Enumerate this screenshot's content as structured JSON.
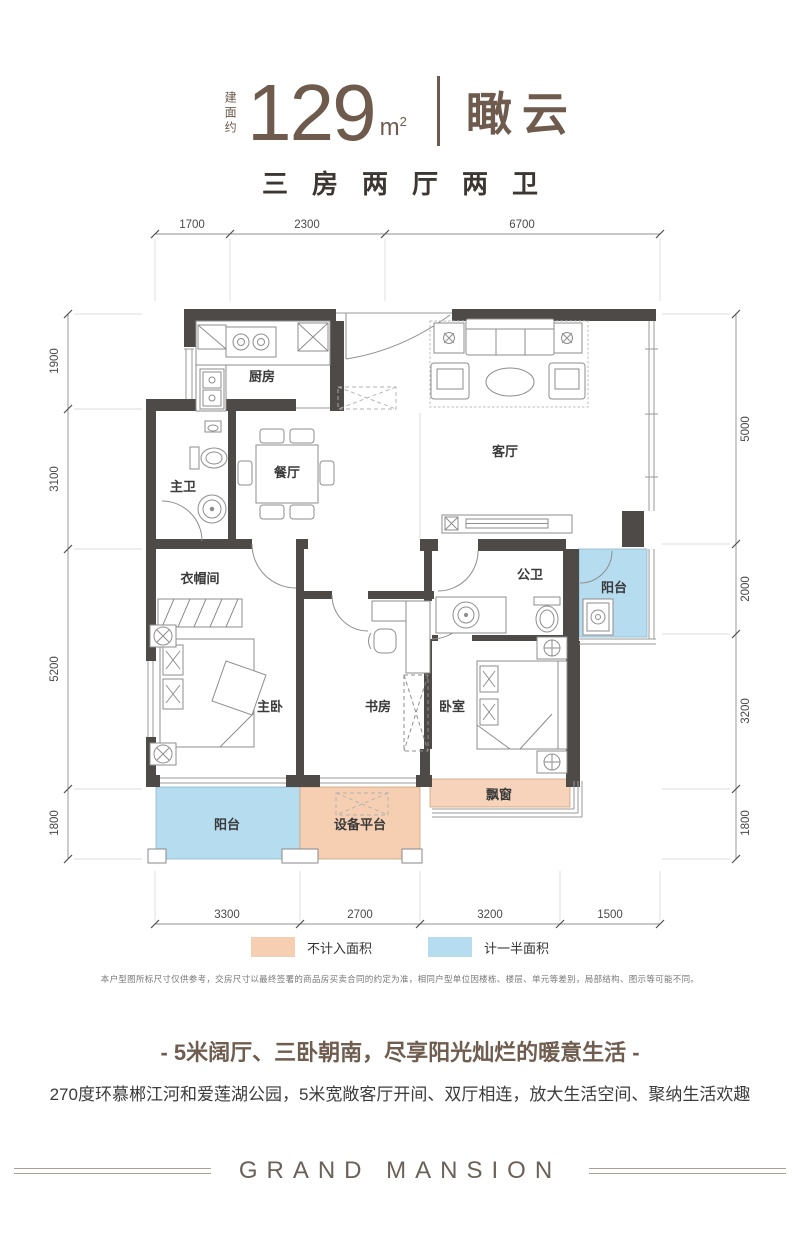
{
  "header": {
    "area_label": "建面约",
    "area_value": "129",
    "area_unit": "m",
    "area_unit_sup": "2",
    "unit_name": "瞰云",
    "layout_summary": "三房两厅两卫"
  },
  "plan": {
    "rooms": {
      "kitchen": "厨房",
      "dining": "餐厅",
      "living": "客厅",
      "master_bath": "主卫",
      "cloakroom": "衣帽间",
      "master_bedroom": "主卧",
      "study": "书房",
      "bedroom": "卧室",
      "public_bath": "公卫",
      "balcony_right": "阳台",
      "balcony_bottom": "阳台",
      "equipment_platform": "设备平台",
      "bay_window": "飘窗"
    },
    "dims": {
      "top": [
        "1700",
        "2300",
        "6700"
      ],
      "left": [
        "1900",
        "3100",
        "5200",
        "1800"
      ],
      "right": [
        "5000",
        "2000",
        "3200",
        "1800"
      ],
      "bottom": [
        "3300",
        "2700",
        "3200",
        "1500"
      ]
    },
    "colors": {
      "wall": "#4d4a47",
      "half_area_fill": "#b5dcef",
      "no_area_fill": "#f6cfb2"
    }
  },
  "legend": {
    "items": [
      {
        "label": "不计入面积",
        "color": "#f6cfb2"
      },
      {
        "label": "计一半面积",
        "color": "#b5dcef"
      }
    ]
  },
  "disclaimer": "本户型图所标尺寸仅供参考，交房尺寸以最终签署的商品房买卖合同的约定为准，相同户型单位因楼栋、楼层、单元等差别，局部结构、图示等可能不同。",
  "tagline": "- 5米阔厅、三卧朝南，尽享阳光灿烂的暖意生活 -",
  "description": "270度环慕郴江河和爱莲湖公园，5米宽敞客厅开间、双厅相连，放大生活空间、聚纳生活欢趣",
  "footer": {
    "brand": "GRAND MANSION"
  }
}
